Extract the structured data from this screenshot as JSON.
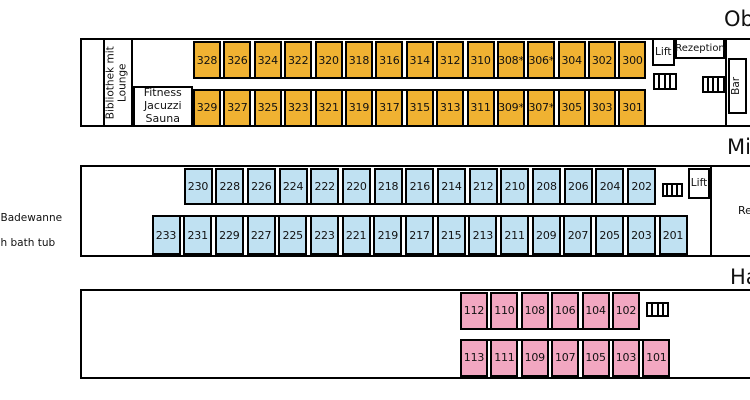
{
  "colors": {
    "oberdeck_cabin": "#f0b232",
    "mitteldeck_cabin": "#c0e1f2",
    "hauptdeck_cabin": "#f2a7c1",
    "outline": "#000000",
    "background": "#ffffff"
  },
  "legend": {
    "badewanne_fragment": "Badewanne",
    "bathtub_fragment": "h bath tub"
  },
  "decks": {
    "oberdeck": {
      "label_fragment": "Ob",
      "cabin_color": "#f0b232",
      "library_line1": "Bibliothek mit",
      "library_line2": "Lounge",
      "fitness_line1": "Fitness",
      "fitness_line2": "Jacuzzi",
      "fitness_line3": "Sauna",
      "lift_label": "Lift",
      "reception_label": "Rezeption",
      "bar_label": "Bar",
      "rows": [
        [
          "328",
          "326",
          "324",
          "322",
          "320",
          "318",
          "316",
          "314",
          "312",
          "310",
          "308*",
          "306*",
          "304",
          "302",
          "300"
        ],
        [
          "329",
          "327",
          "325",
          "323",
          "321",
          "319",
          "317",
          "315",
          "313",
          "311",
          "309*",
          "307*",
          "305",
          "303",
          "301"
        ]
      ]
    },
    "mitteldeck": {
      "label_fragment": "Mi",
      "cabin_color": "#c0e1f2",
      "lift_label": "Lift",
      "restaurant_fragment": "Re",
      "rows": [
        [
          "230",
          "228",
          "226",
          "224",
          "222",
          "220",
          "218",
          "216",
          "214",
          "212",
          "210",
          "208",
          "206",
          "204",
          "202"
        ],
        [
          "233",
          "231",
          "229",
          "227",
          "225",
          "223",
          "221",
          "219",
          "217",
          "215",
          "213",
          "211",
          "209",
          "207",
          "205",
          "203",
          "201"
        ]
      ]
    },
    "hauptdeck": {
      "label_fragment": "Ha",
      "cabin_color": "#f2a7c1",
      "rows": [
        [
          "112",
          "110",
          "108",
          "106",
          "104",
          "102"
        ],
        [
          "113",
          "111",
          "109",
          "107",
          "105",
          "103",
          "101"
        ]
      ]
    }
  }
}
